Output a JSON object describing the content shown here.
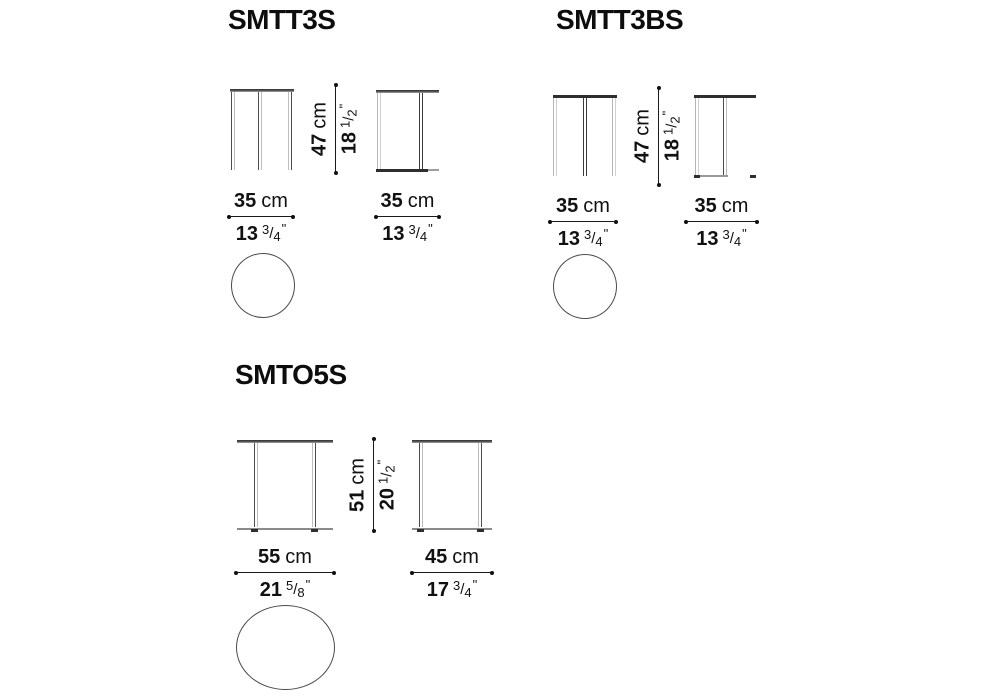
{
  "units": {
    "metric": "cm",
    "slash": "/",
    "prime": "\""
  },
  "products": [
    {
      "code": "SMTT3S",
      "top_view_shape": "circle",
      "height": {
        "cm": "47",
        "imp": "18",
        "fn": "1",
        "fd": "2"
      },
      "front": {
        "cm": "35",
        "imp": "13",
        "fn": "3",
        "fd": "4"
      },
      "side": {
        "cm": "35",
        "imp": "13",
        "fn": "3",
        "fd": "4"
      }
    },
    {
      "code": "SMTT3BS",
      "top_view_shape": "circle",
      "height": {
        "cm": "47",
        "imp": "18",
        "fn": "1",
        "fd": "2"
      },
      "front": {
        "cm": "35",
        "imp": "13",
        "fn": "3",
        "fd": "4"
      },
      "side": {
        "cm": "35",
        "imp": "13",
        "fn": "3",
        "fd": "4"
      }
    },
    {
      "code": "SMTO5S",
      "top_view_shape": "ellipse",
      "height": {
        "cm": "51",
        "imp": "20",
        "fn": "1",
        "fd": "2"
      },
      "front": {
        "cm": "55",
        "imp": "21",
        "fn": "5",
        "fd": "8"
      },
      "side": {
        "cm": "45",
        "imp": "17",
        "fn": "3",
        "fd": "4"
      }
    }
  ],
  "colors": {
    "line_dark": "#2e2e2e",
    "line_light": "#b5b5b5",
    "text": "#111111",
    "background": "#ffffff"
  }
}
